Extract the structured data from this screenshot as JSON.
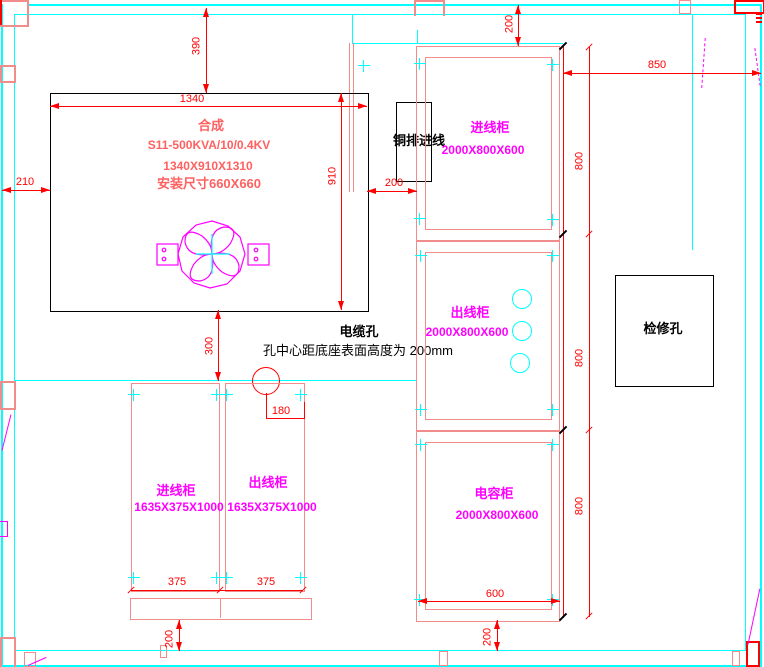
{
  "drawing": {
    "transformer": {
      "line1": "合成",
      "line2": "S11-500KVA/10/0.4KV",
      "line3": "1340X910X1310",
      "line4": "安装尺寸660X660"
    },
    "busbar_inlet_label": "铜排进线",
    "cable_hole": {
      "title": "电缆孔",
      "note": "孔中心距底座表面高度为 200mm"
    },
    "access_hole_label": "检修孔"
  },
  "cabinets_right": [
    {
      "name": "进线柜",
      "size": "2000X800X600"
    },
    {
      "name": "出线柜",
      "size": "2000X800X600"
    },
    {
      "name": "电容柜",
      "size": "2000X800X600"
    }
  ],
  "cabinets_bottom": [
    {
      "name": "进线柜",
      "size": "1635X375X1000"
    },
    {
      "name": "出线柜",
      "size": "1635X375X1000"
    }
  ],
  "dimensions": {
    "d390": "390",
    "d1340": "1340",
    "d210": "210",
    "d910": "910",
    "d200_gap": "200",
    "d300": "300",
    "d180": "180",
    "d200_top": "200",
    "d850": "850",
    "d800": [
      "800",
      "800",
      "800"
    ],
    "d600": "600",
    "d200_bottom_right": "200",
    "d200_bottom_left": "200",
    "d375": [
      "375",
      "375"
    ]
  },
  "colors": {
    "wall": "#00FFFF",
    "dimension": "#FF0000",
    "cabinet_outline": "#F08C8C",
    "cabinet_label": "#FF00FF",
    "transformer_text": "#FF6060",
    "drawing_ink": "#000000"
  }
}
